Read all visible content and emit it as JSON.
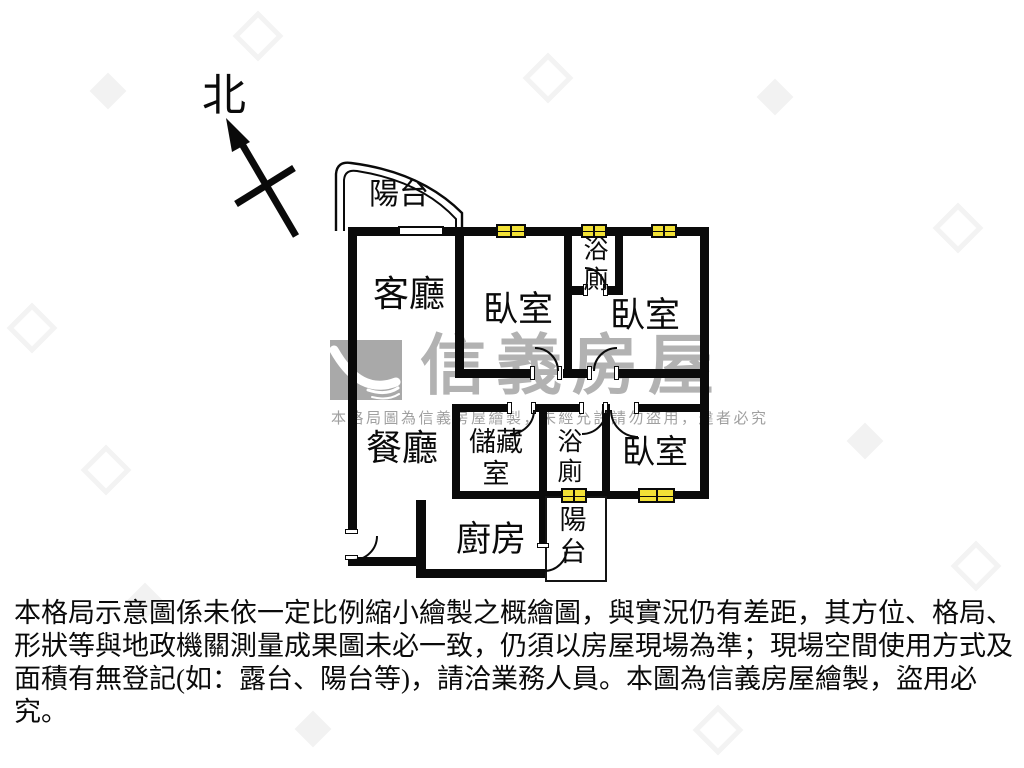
{
  "compass": {
    "north_label": "北"
  },
  "rooms": {
    "balcony_top": {
      "label": "陽台"
    },
    "living": {
      "label": "客廳"
    },
    "bedroom1": {
      "label": "臥室"
    },
    "bath_top": {
      "label": "浴廁"
    },
    "bedroom2": {
      "label": "臥室"
    },
    "dining": {
      "label": "餐廳"
    },
    "storage": {
      "label": "儲藏室"
    },
    "bath_lower": {
      "label": "浴廁"
    },
    "bedroom3": {
      "label": "臥室"
    },
    "kitchen": {
      "label": "廚房"
    },
    "balcony_bottom": {
      "label": "陽台"
    }
  },
  "watermark": {
    "brand": "信義房屋",
    "notice": "本格局圖為信義房屋繪製，未經允許請勿盜用，違者必究"
  },
  "disclaimer": {
    "line1": "本格局示意圖係未依一定比例縮小繪製之概繪圖，與實況仍有差距，其方位、格局、",
    "line2": "形狀等與地政機關測量成果圖未必一致，仍須以房屋現場為準；現場空間使用方式及",
    "line3": "面積有無登記(如：露台、陽台等)，請洽業務人員。本圖為信義房屋繪製，盜用必究。"
  },
  "colors": {
    "wall": "#0a0a0a",
    "window_fill": "#f2e136",
    "watermark_gray": "#b2b2b2"
  }
}
